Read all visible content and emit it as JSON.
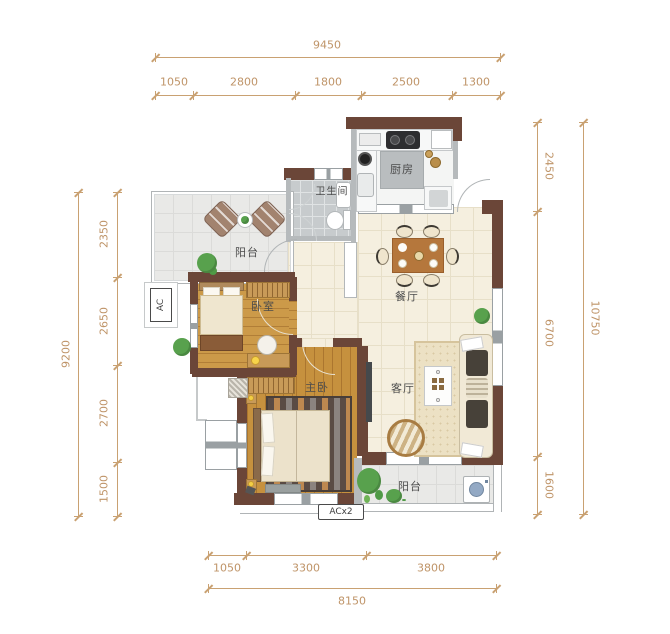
{
  "rooms": {
    "balcony_top": "阳台",
    "bathroom": "卫生间",
    "kitchen": "厨房",
    "dining": "餐厅",
    "bedroom": "卧室",
    "master": "主卧",
    "living": "客厅",
    "balcony_bottom": "阳台"
  },
  "annotations": {
    "ac": "AC",
    "acx2": "ACx2"
  },
  "dimensions": {
    "top": {
      "total": "9450",
      "segments": [
        "1050",
        "2800",
        "1800",
        "2500",
        "1300"
      ]
    },
    "bottom": {
      "total": "8150",
      "segments": [
        "1050",
        "3300",
        "3800"
      ]
    },
    "left": {
      "total": "9200",
      "segments": [
        "2350",
        "2650",
        "2700",
        "1500"
      ]
    },
    "right": {
      "total": "10750",
      "segments": [
        "2450",
        "6700",
        "1600"
      ]
    }
  },
  "colors": {
    "wall": "#6B4638",
    "dimension": "#C9A172",
    "wood_floor": "#C6913E",
    "cream_tile": "#F5EFDF",
    "plant_green": "#58A14D"
  }
}
